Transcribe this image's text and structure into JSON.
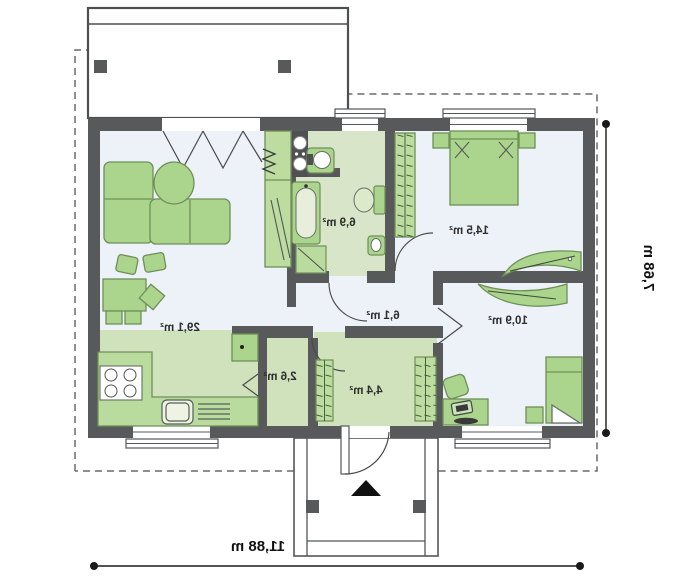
{
  "plan": {
    "type": "floor-plan",
    "rooms": [
      {
        "id": "living-room-kitchen",
        "area": "29,1 m²"
      },
      {
        "id": "bathroom",
        "area": "6,9 m²"
      },
      {
        "id": "bedroom",
        "area": "14,5 m²"
      },
      {
        "id": "hall",
        "area": "6,1 m²"
      },
      {
        "id": "pantry",
        "area": "2,6 m²"
      },
      {
        "id": "entry",
        "area": "4,4 m²"
      },
      {
        "id": "bedroom-2",
        "area": "10,9 m²"
      }
    ],
    "dimensions": {
      "overall_width": "11,88 m",
      "overall_depth": "7,68 m"
    },
    "colors": {
      "wall": "#58595b",
      "floor_light": "#edf1f8",
      "floor_green": "#cfe2bc",
      "floor_green_bath": "#d8e5c8",
      "wardrobe_fill": "#bcdca0",
      "furniture_fill": "#abd48d",
      "furniture_stroke": "#6f8f58",
      "dashed_outline": "#6a6a6a",
      "dimension": "#1a1a1a"
    },
    "icons": {
      "entrance_marker": "triangle-up"
    }
  }
}
